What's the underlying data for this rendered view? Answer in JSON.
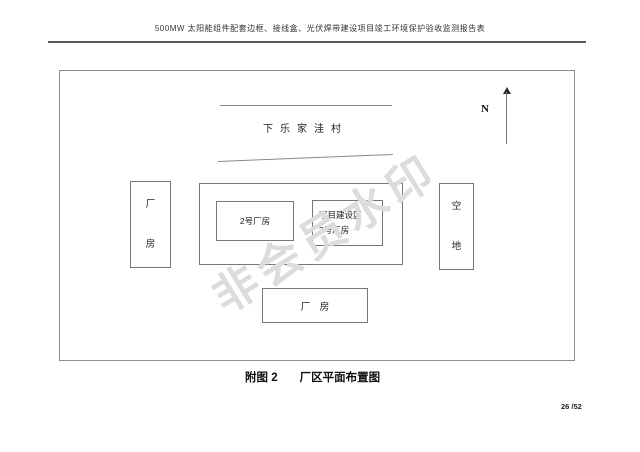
{
  "page": {
    "header_title": "500MW 太阳能组件配套边框、接线盒、光伏焊带建设项目竣工环境保护验收监测报告表",
    "page_number": "26 /52"
  },
  "figure": {
    "village_label": "下乐家洼村",
    "north_label": "N",
    "factory_left_label": "厂房",
    "factory_2_label": "2号厂房",
    "project_area_line1": "项目建设区",
    "project_area_line2": "3号厂房",
    "empty_land_label": "空地",
    "factory_bottom_label": "厂　房",
    "watermark": "非会员水印",
    "caption_figure_no": "附图 2",
    "caption_title": "厂区平面布置图"
  },
  "colors": {
    "diagram_border_gray": "#8c8c8c",
    "box_border_gray": "#777777",
    "header_rule_gray": "#5a5a5a",
    "text_black": "#1a1a1a",
    "watermark_gray": "#dcdcdc"
  }
}
